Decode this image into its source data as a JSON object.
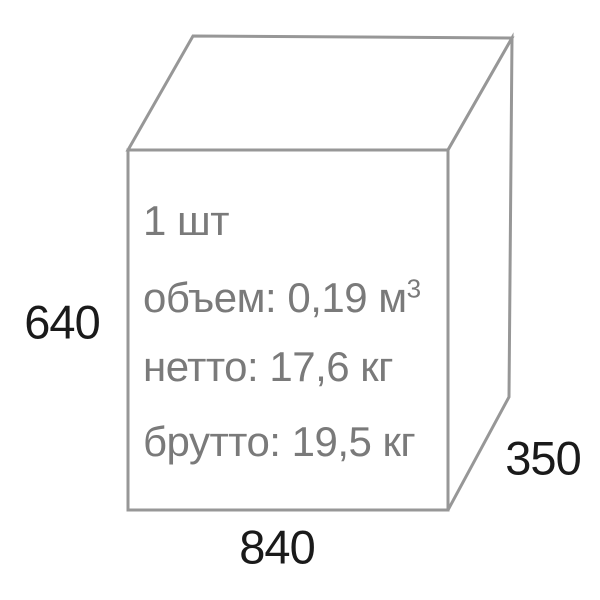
{
  "colors": {
    "background": "#ffffff",
    "box_stroke": "#979797",
    "inner_text": "#7a7a7a",
    "dimension_text": "#1a1a1a"
  },
  "package": {
    "quantity": "1 шт",
    "volume_prefix": "объем: 0,19 м",
    "volume_exponent": "3",
    "net_weight": "нетто: 17,6 кг",
    "gross_weight": "брутто: 19,5 кг"
  },
  "dimensions": {
    "height": "640",
    "width": "840",
    "depth": "350"
  }
}
